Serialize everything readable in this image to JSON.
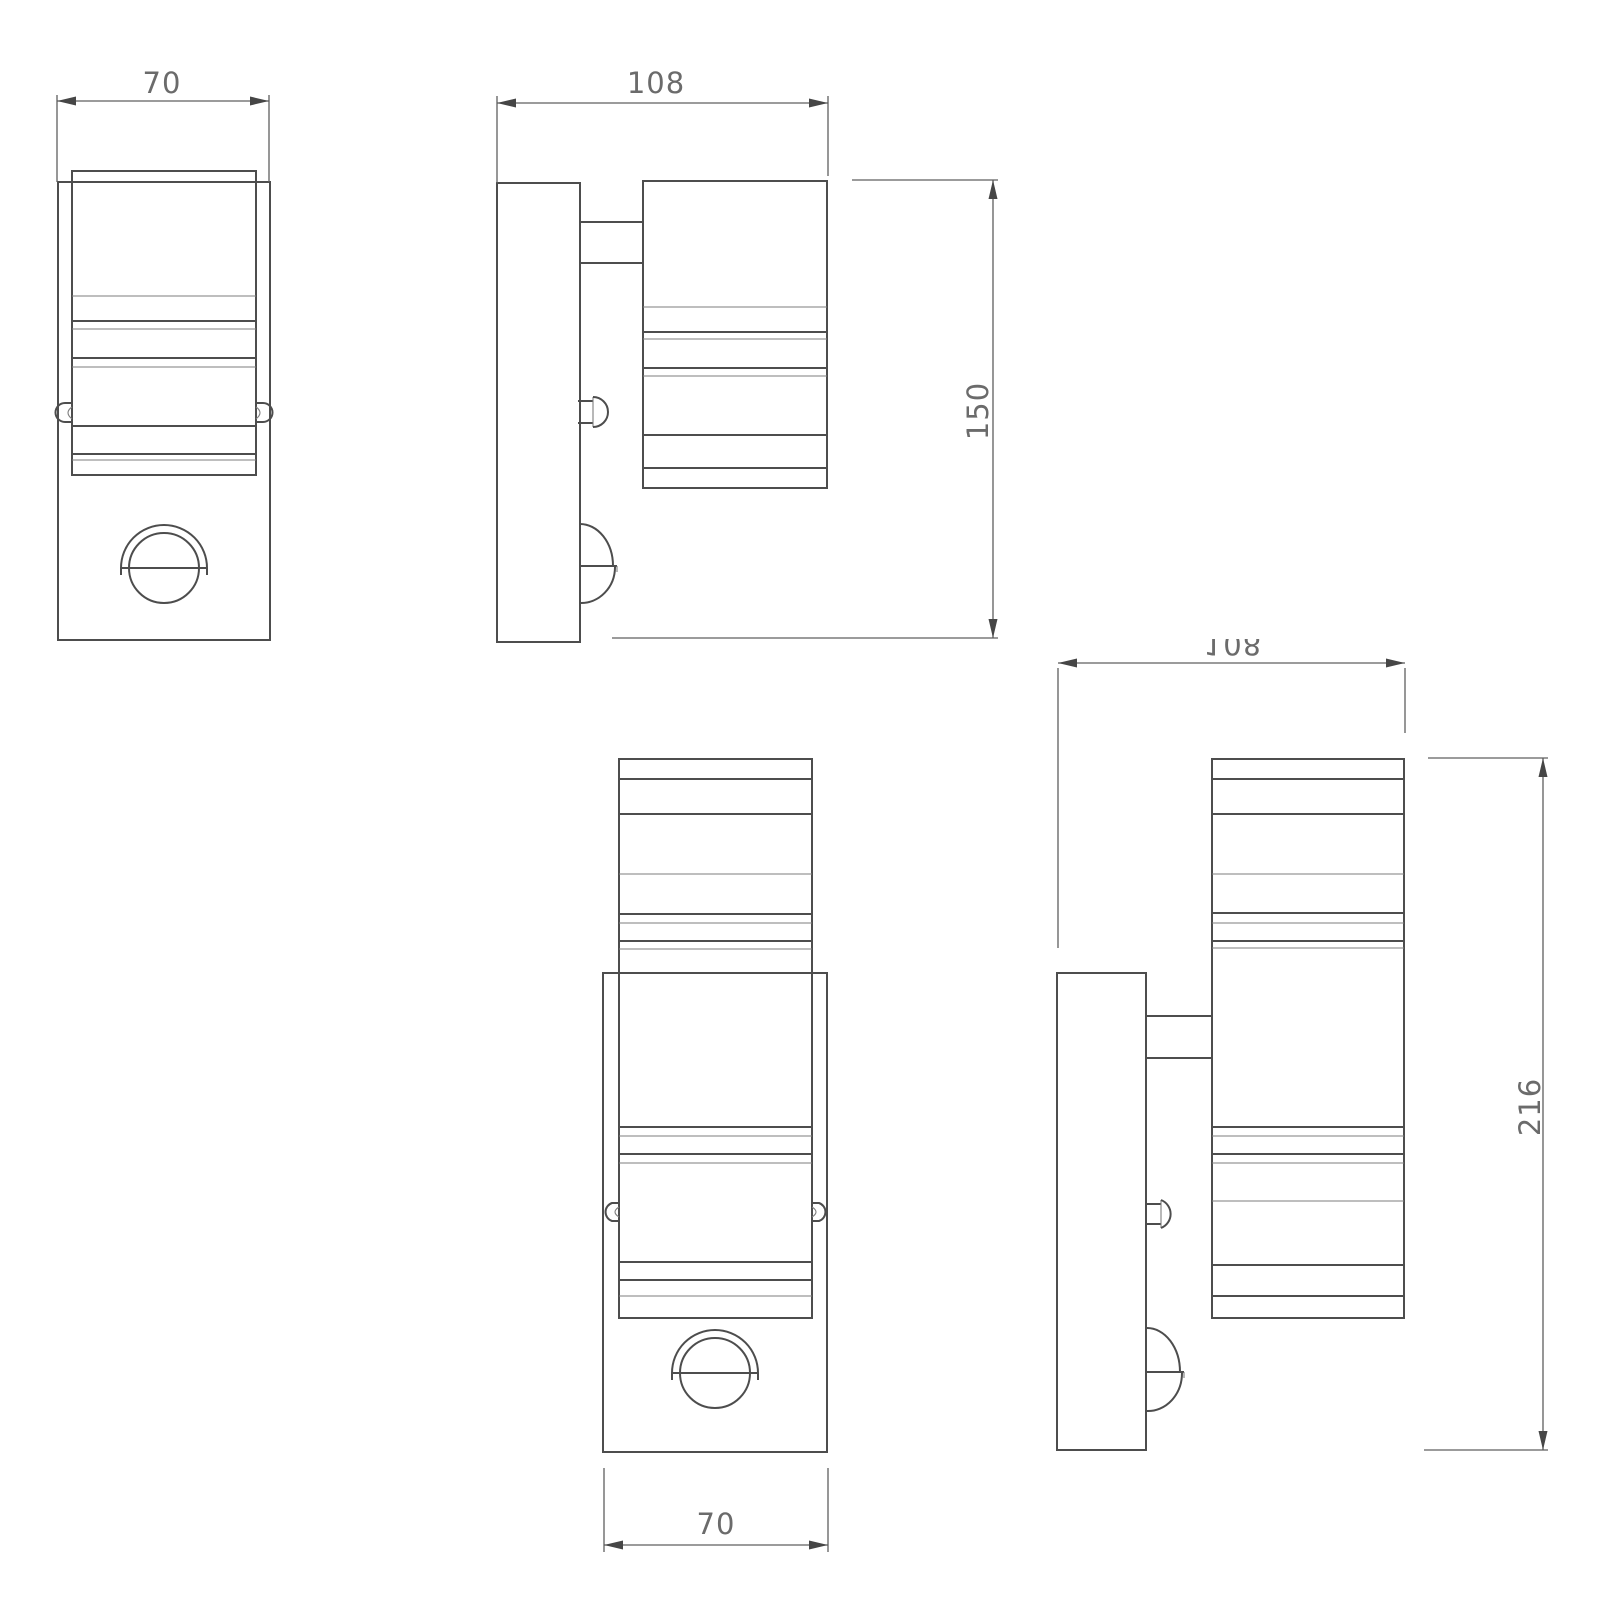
{
  "colors": {
    "background": "#ffffff",
    "outline": "#4d4d4d",
    "thin_line": "#7d7d7d",
    "dimension_line": "#5f5f5f",
    "dimension_text": "#6b6b6b"
  },
  "drawing": {
    "views": [
      {
        "id": "front-view-single",
        "position": "top-left"
      },
      {
        "id": "side-view-single",
        "position": "top-middle"
      },
      {
        "id": "front-view-double",
        "position": "bottom-middle"
      },
      {
        "id": "side-view-double",
        "position": "bottom-right"
      }
    ]
  },
  "dimension_labels": {
    "front_single_width": "70",
    "side_single_depth": "108",
    "side_single_height": "150",
    "front_double_width": "70",
    "side_double_depth": "108",
    "side_double_height": "216"
  }
}
